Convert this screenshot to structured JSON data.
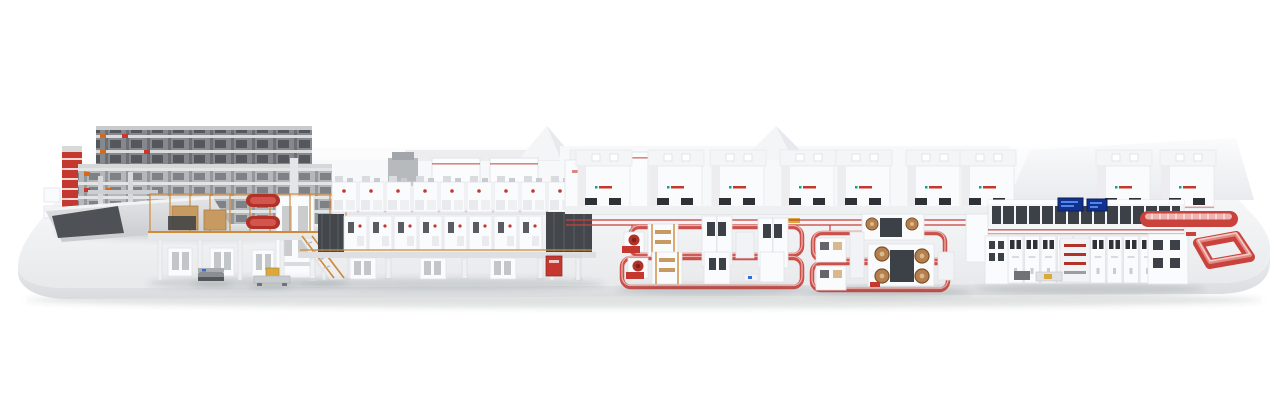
{
  "scene": {
    "kind": "3d-product-render",
    "subject": "panoramic end-to-end industrial production line mounted on a long rounded white platform",
    "visible_text": "none"
  },
  "canvas": {
    "width": 1280,
    "height": 405,
    "background": "#ffffff"
  },
  "colors": {
    "page_bg": "#ffffff",
    "platform_top_light": "#fdfdfe",
    "platform_top_dark": "#e7e9eb",
    "platform_front_light": "#f2f3f5",
    "platform_front_dark": "#d9dbde",
    "wall_white": "#f7f8fa",
    "roof_shade": "#e9ebee",
    "machine_white": "#fafbfc",
    "panel_stroke": "#e1e3e7",
    "dark_glass": "#3c4147",
    "rack_dark": "#85888c",
    "rack_light": "#b5b8bb",
    "scaffold_orange": "#cf8a3a",
    "wood_tan": "#c79a62",
    "copper": "#b5804d",
    "copper_dark": "#7c5229",
    "coil_red": "#b03228",
    "accent_red": "#c5382f",
    "line_red": "#c9423c",
    "screen_blue": "#12318f",
    "screen_glow": "#4f86e8",
    "agv_yellow": "#d9a93c",
    "shadow": "rgba(70,75,80,0.16)"
  },
  "zones": [
    {
      "id": "storage-rack-zone"
    },
    {
      "id": "infeed-ramp"
    },
    {
      "id": "unwind-mezzanine"
    },
    {
      "id": "coating-drying-line"
    },
    {
      "id": "process-chambers"
    },
    {
      "id": "winding-cell-group-a"
    },
    {
      "id": "winding-cell-group-b"
    },
    {
      "id": "assembly-inspection-line"
    },
    {
      "id": "outfeed-conveyor-loop"
    },
    {
      "id": "agv-shuttles"
    }
  ],
  "layout_data": {
    "process_chambers": {
      "y": 150,
      "positions": [
        578,
        650,
        712,
        782,
        838,
        908,
        962
      ],
      "right_positions": [
        1098,
        1162
      ],
      "width": 52
    },
    "coating_top_row": {
      "x0": 332,
      "gap": 27,
      "count": 9
    },
    "coating_mid_row": {
      "x0": 344,
      "gap": 25,
      "count": 8
    },
    "coating_legs": {
      "x0": 310,
      "gap": 38,
      "count": 8
    },
    "assembly_cabinets": {
      "x0": 1008,
      "gap": 16.5,
      "count": 9
    },
    "floor_loops": [
      {
        "x": 630,
        "y": 227,
        "w": 172,
        "h": 28
      },
      {
        "x": 622,
        "y": 258,
        "w": 180,
        "h": 29
      },
      {
        "x": 813,
        "y": 233,
        "w": 132,
        "h": 27
      },
      {
        "x": 812,
        "y": 263,
        "w": 136,
        "h": 27
      }
    ],
    "status_screens": [
      {
        "x": 1058,
        "y": 198,
        "w": 25,
        "h": 13
      },
      {
        "x": 1087,
        "y": 199,
        "w": 20,
        "h": 12
      }
    ]
  }
}
